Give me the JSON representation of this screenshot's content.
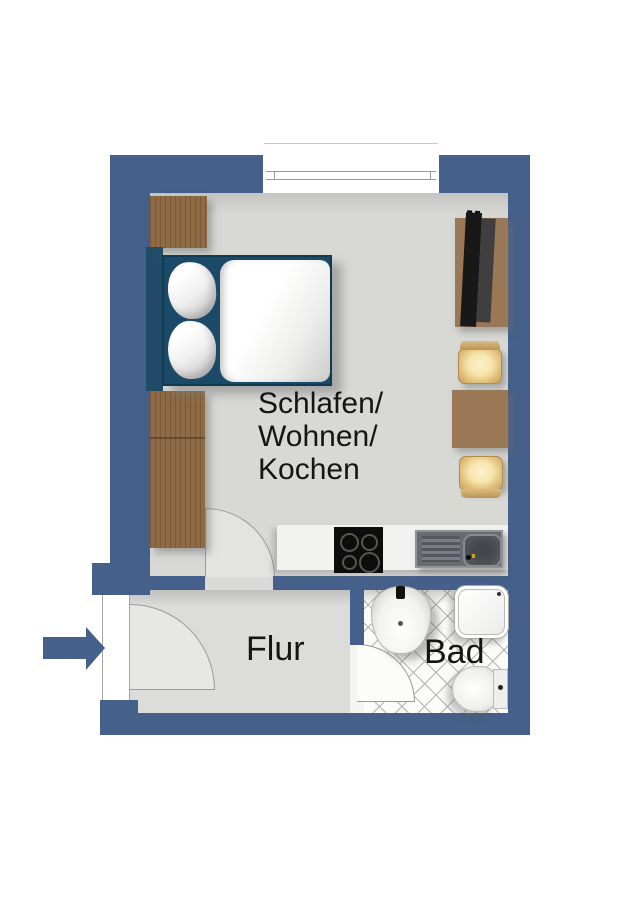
{
  "plan": {
    "rooms": {
      "main": {
        "label_lines": [
          "Schlafen/",
          "Wohnen/",
          "Kochen"
        ]
      },
      "hallway": {
        "label": "Flur"
      },
      "bathroom": {
        "label": "Bad"
      }
    },
    "colors": {
      "wall_blue": "#45608a",
      "floor_gray": "#d8d8d5",
      "wardrobe_wood": "#8d6b44",
      "furniture_wood": "#9b7855",
      "bed_frame_navy": "#1a4a68",
      "chair_seat_tan": "#f6e5ab",
      "tile_line_gray": "#b2b2b0",
      "label_text": "#151515"
    },
    "furniture_icons": [
      "wardrobe",
      "double-bed",
      "tv-sideboard",
      "tv",
      "chair",
      "dining-table",
      "chair",
      "kitchen-counter",
      "cooktop",
      "kitchen-sink",
      "washbasin",
      "shower",
      "toilet",
      "entrance-arrow",
      "window",
      "door-swing"
    ]
  }
}
